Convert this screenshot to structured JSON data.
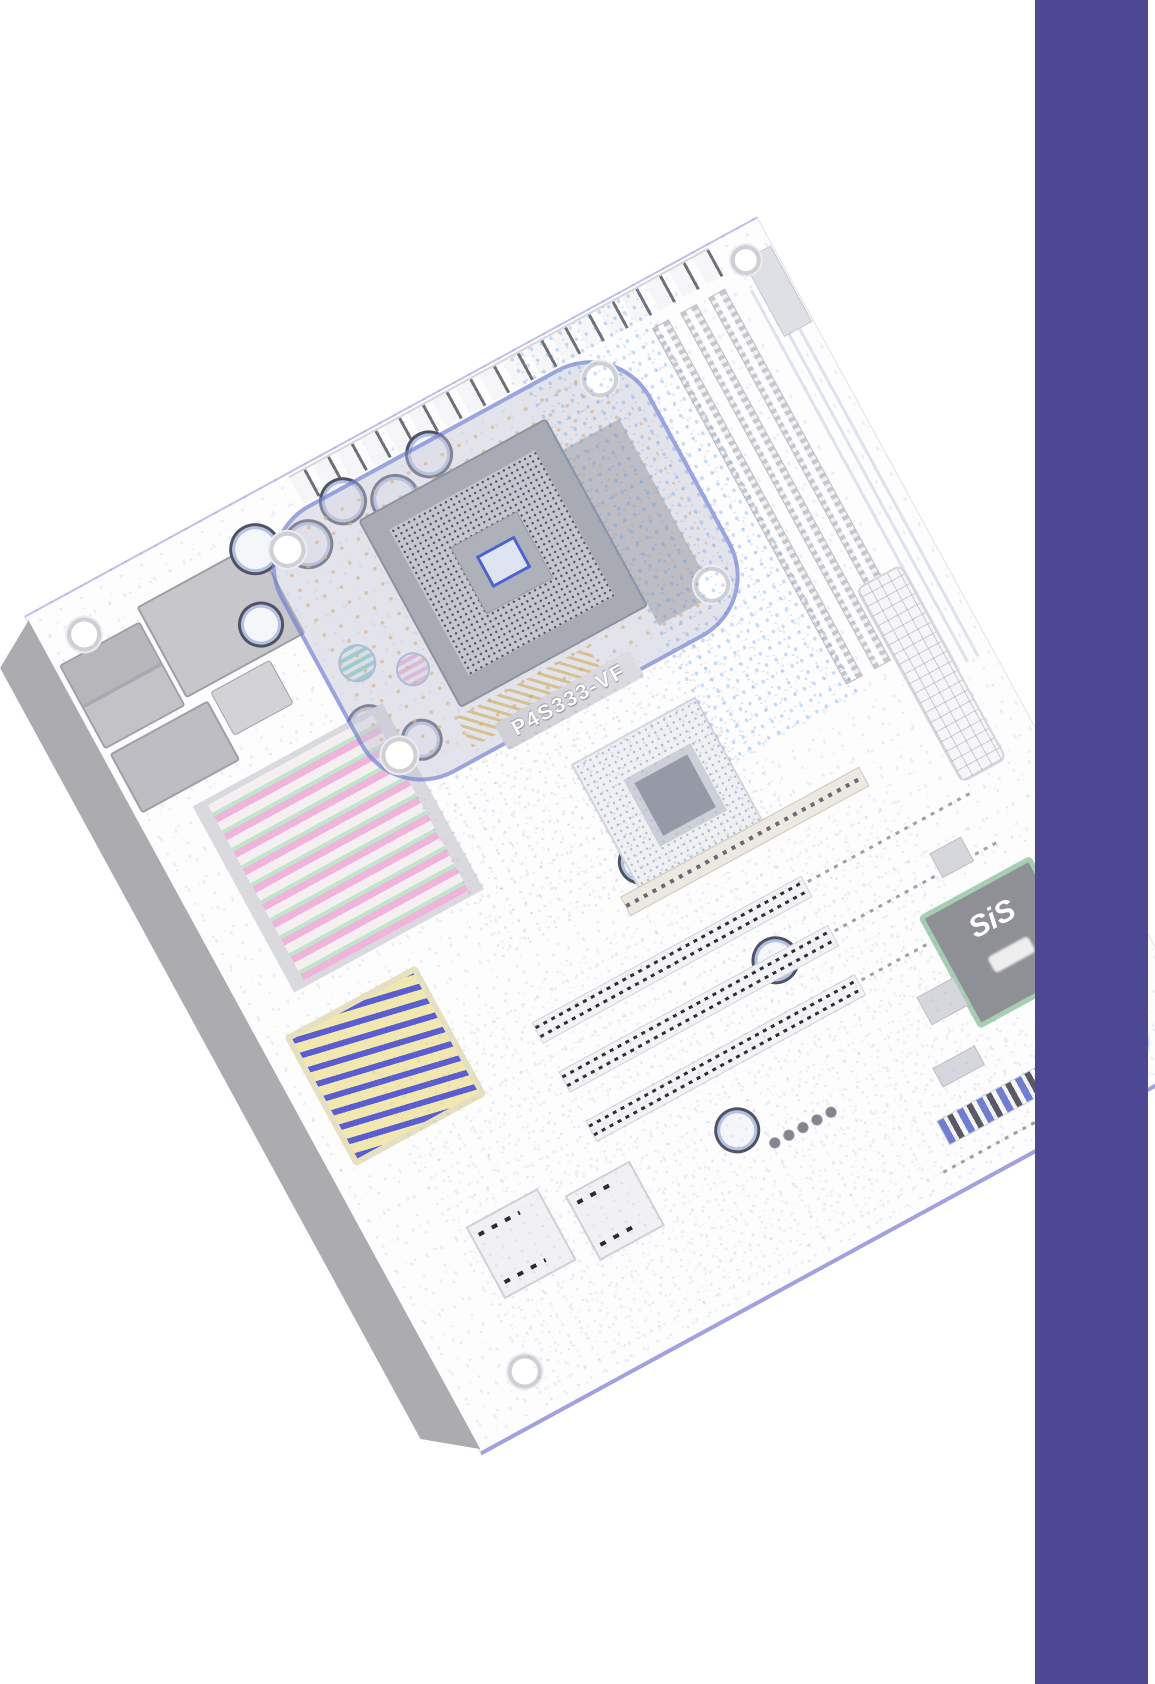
{
  "page": {
    "background_color": "#ffffff",
    "accent_bar_color": "#4e4794"
  },
  "motherboard_photo": {
    "model_label": "P4S333-VF",
    "chipset_logo": "SiS",
    "shadow_color": "#acacb0",
    "socket_color": "#a8aab4",
    "chip_body_color": "#8f9096",
    "chip_border_color": "#a6ceb2",
    "retention_outline_color": "#5064cd",
    "board_edge_color": "#5555c8"
  }
}
